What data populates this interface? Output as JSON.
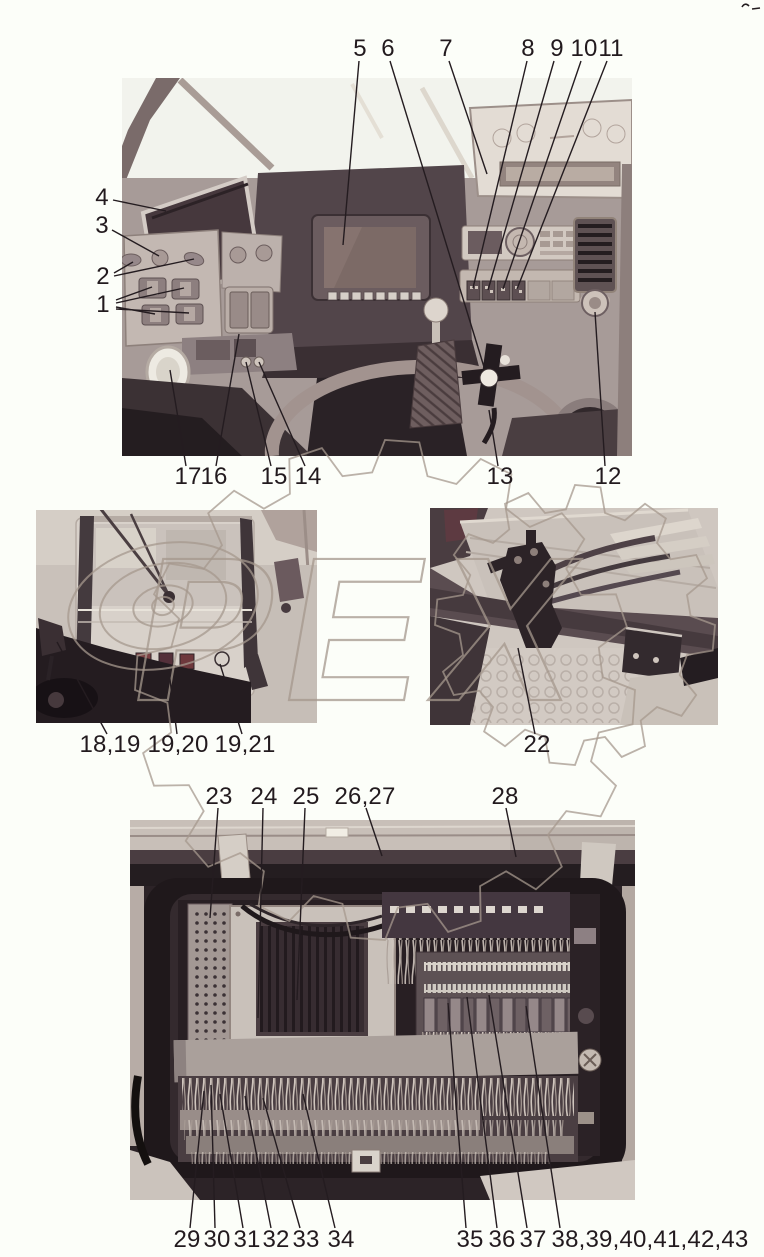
{
  "page": {
    "width": 764,
    "height": 1257,
    "background": "#fcfef9",
    "ink": "#221a1e",
    "line_color": "#241c20",
    "line_width": 1.4,
    "label_font_px": 24
  },
  "watermark": {
    "text": "ОРЕХ",
    "color": "#a5988d",
    "opacity": 0.75,
    "letters_x": 248,
    "letters_y": 700,
    "letters_size": 205,
    "skew": -10,
    "o_rings": {
      "cx": 163,
      "cy": 606,
      "rings": [
        [
          96,
          62
        ],
        [
          64,
          42
        ],
        [
          30,
          20
        ],
        [
          11,
          9
        ]
      ],
      "rotate": -12
    },
    "gears": [
      {
        "cx": 385,
        "cy": 690,
        "r_out": 250,
        "r_in": 218,
        "teeth": 16
      },
      {
        "cx": 575,
        "cy": 625,
        "r_out": 140,
        "r_in": 116,
        "teeth": 12
      }
    ]
  },
  "figures": [
    {
      "id": "photo-dashboard",
      "desc": "cab dashboard and controls",
      "x": 122,
      "y": 78,
      "w": 510,
      "h": 378
    },
    {
      "id": "photo-cab-rear",
      "desc": "cab rear exterior with lamps",
      "x": 36,
      "y": 510,
      "w": 281,
      "h": 213
    },
    {
      "id": "photo-underside",
      "desc": "underside valve block and hoses",
      "x": 430,
      "y": 508,
      "w": 288,
      "h": 217
    },
    {
      "id": "photo-electrical-box",
      "desc": "electrical compartment",
      "x": 130,
      "y": 820,
      "w": 505,
      "h": 380
    }
  ],
  "callouts": [
    {
      "label": "1",
      "x": 103,
      "y": 305,
      "lines": [
        [
          116,
          300,
          152,
          287
        ],
        [
          116,
          303,
          184,
          288
        ],
        [
          116,
          307,
          155,
          314
        ],
        [
          116,
          309,
          189,
          313
        ]
      ]
    },
    {
      "label": "2",
      "x": 103,
      "y": 277,
      "lines": [
        [
          114,
          273,
          133,
          262
        ],
        [
          114,
          276,
          194,
          259
        ]
      ]
    },
    {
      "label": "3",
      "x": 102,
      "y": 226,
      "lines": [
        [
          112,
          230,
          159,
          256
        ]
      ]
    },
    {
      "label": "4",
      "x": 102,
      "y": 198,
      "lines": [
        [
          113,
          200,
          166,
          211
        ]
      ]
    },
    {
      "label": "5",
      "x": 360,
      "y": 49,
      "lines": [
        [
          359,
          61,
          343,
          245
        ]
      ]
    },
    {
      "label": "6",
      "x": 388,
      "y": 49,
      "lines": [
        [
          390,
          61,
          484,
          367
        ]
      ]
    },
    {
      "label": "7",
      "x": 446,
      "y": 49,
      "lines": [
        [
          449,
          61,
          487,
          174
        ]
      ]
    },
    {
      "label": "8",
      "x": 528,
      "y": 49,
      "lines": [
        [
          527,
          61,
          473,
          288
        ]
      ]
    },
    {
      "label": "9",
      "x": 557,
      "y": 49,
      "lines": [
        [
          554,
          61,
          488,
          290
        ]
      ]
    },
    {
      "label": "10",
      "x": 584,
      "y": 49,
      "lines": [
        [
          581,
          61,
          503,
          289
        ]
      ]
    },
    {
      "label": "11",
      "x": 611,
      "y": 49,
      "lines": [
        [
          607,
          61,
          517,
          289
        ]
      ]
    },
    {
      "label": "12",
      "x": 608,
      "y": 477,
      "lines": [
        [
          605,
          466,
          595,
          312
        ]
      ]
    },
    {
      "label": "13",
      "x": 500,
      "y": 477,
      "lines": [
        [
          498,
          466,
          489,
          410
        ]
      ]
    },
    {
      "label": "14",
      "x": 308,
      "y": 477,
      "lines": [
        [
          305,
          466,
          259,
          362
        ]
      ]
    },
    {
      "label": "15",
      "x": 274,
      "y": 477,
      "lines": [
        [
          271,
          466,
          246,
          362
        ]
      ]
    },
    {
      "label": "16",
      "x": 214,
      "y": 477,
      "lines": [
        [
          216,
          466,
          239,
          334
        ]
      ]
    },
    {
      "label": "17",
      "x": 188,
      "y": 477,
      "lines": [
        [
          186,
          466,
          170,
          370
        ]
      ]
    },
    {
      "label": "18,19",
      "x": 110,
      "y": 745,
      "lines": [
        [
          107,
          734,
          57,
          642
        ]
      ]
    },
    {
      "label": "19,20",
      "x": 178,
      "y": 745,
      "lines": [
        [
          177,
          734,
          169,
          672
        ]
      ]
    },
    {
      "label": "19,21",
      "x": 245,
      "y": 745,
      "lines": [
        [
          242,
          734,
          220,
          664
        ]
      ]
    },
    {
      "label": "22",
      "x": 537,
      "y": 745,
      "lines": [
        [
          535,
          734,
          518,
          648
        ]
      ]
    },
    {
      "label": "23",
      "x": 219,
      "y": 797,
      "lines": [
        [
          218,
          808,
          210,
          918
        ]
      ]
    },
    {
      "label": "24",
      "x": 264,
      "y": 797,
      "lines": [
        [
          263,
          808,
          258,
          1018
        ]
      ]
    },
    {
      "label": "25",
      "x": 306,
      "y": 797,
      "lines": [
        [
          305,
          808,
          297,
          1000
        ]
      ]
    },
    {
      "label": "26,27",
      "x": 365,
      "y": 797,
      "lines": [
        [
          366,
          808,
          382,
          856
        ]
      ]
    },
    {
      "label": "28",
      "x": 505,
      "y": 797,
      "lines": [
        [
          506,
          808,
          516,
          857
        ]
      ]
    },
    {
      "label": "29",
      "x": 187,
      "y": 1240,
      "lines": [
        [
          190,
          1228,
          204,
          1091
        ]
      ]
    },
    {
      "label": "30",
      "x": 217,
      "y": 1240,
      "lines": [
        [
          215,
          1228,
          211,
          1085
        ]
      ]
    },
    {
      "label": "31",
      "x": 247,
      "y": 1240,
      "lines": [
        [
          243,
          1228,
          220,
          1094
        ]
      ]
    },
    {
      "label": "32",
      "x": 276,
      "y": 1240,
      "lines": [
        [
          271,
          1228,
          245,
          1096
        ]
      ]
    },
    {
      "label": "33",
      "x": 306,
      "y": 1240,
      "lines": [
        [
          300,
          1228,
          263,
          1098
        ]
      ]
    },
    {
      "label": "34",
      "x": 341,
      "y": 1240,
      "lines": [
        [
          335,
          1228,
          303,
          1094
        ]
      ]
    },
    {
      "label": "35",
      "x": 470,
      "y": 1240,
      "lines": [
        [
          466,
          1228,
          448,
          1003
        ]
      ]
    },
    {
      "label": "36",
      "x": 502,
      "y": 1240,
      "lines": [
        [
          497,
          1228,
          467,
          997
        ]
      ]
    },
    {
      "label": "37",
      "x": 533,
      "y": 1240,
      "lines": [
        [
          527,
          1228,
          489,
          995
        ]
      ]
    },
    {
      "label": "38,39,40,41,42,43",
      "x": 650,
      "y": 1240,
      "lines": [
        [
          560,
          1228,
          526,
          1006
        ]
      ]
    }
  ]
}
